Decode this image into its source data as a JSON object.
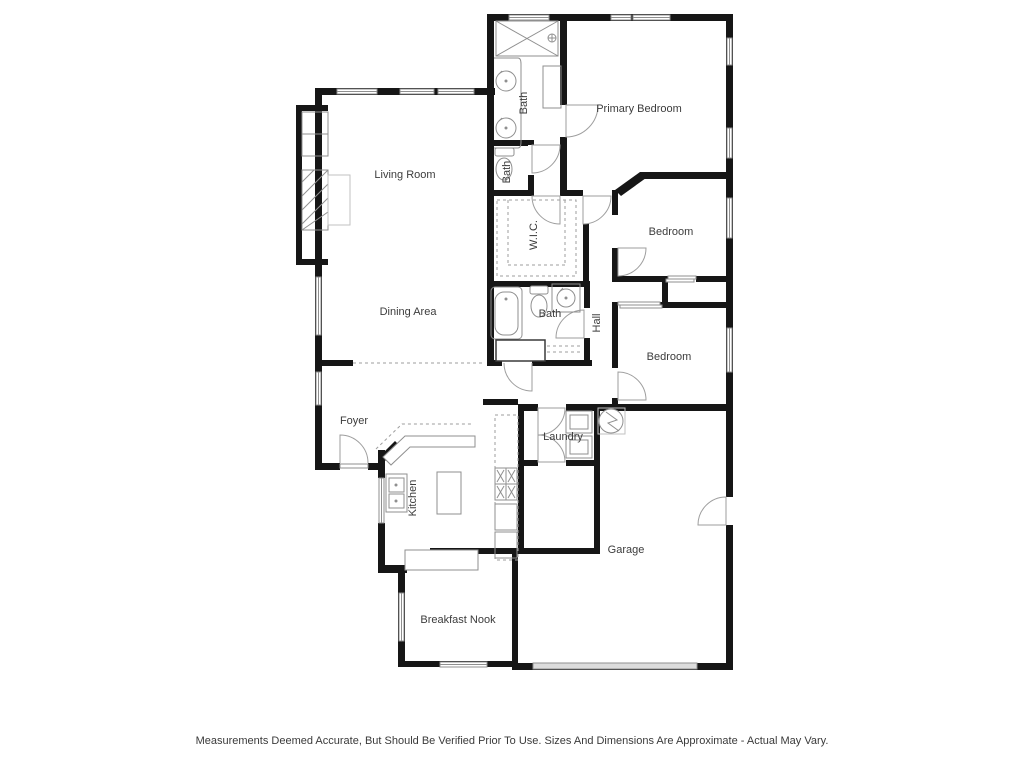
{
  "plan": {
    "rooms": [
      {
        "label": "Living Room"
      },
      {
        "label": "Dining Area"
      },
      {
        "label": "Primary Bedroom"
      },
      {
        "label": "Bath"
      },
      {
        "label": "Bath"
      },
      {
        "label": "W.I.C."
      },
      {
        "label": "Bath"
      },
      {
        "label": "Hall"
      },
      {
        "label": "Bedroom"
      },
      {
        "label": "Bedroom"
      },
      {
        "label": "Foyer"
      },
      {
        "label": "Kitchen"
      },
      {
        "label": "Laundry"
      },
      {
        "label": "Garage"
      },
      {
        "label": "Breakfast Nook"
      }
    ],
    "fixtures": [
      "shower",
      "double-vanity-sinks",
      "bench-cabinet",
      "toilet",
      "walk-in-closet-shelving",
      "bathtub",
      "toilet",
      "vanity-sink",
      "linen-closet",
      "fireplace",
      "built-in-shelves",
      "kitchen-island",
      "kitchen-sink",
      "stove",
      "kitchen-counter",
      "washer",
      "dryer",
      "water-heater",
      "garage-door"
    ],
    "colors": {
      "wall": "#161616",
      "fixture_line": "#8f8f8f",
      "door_arc": "#9e9e9e",
      "label_text": "#3c3c3c",
      "background": "#ffffff"
    },
    "disclaimer": "Measurements Deemed Accurate, But Should Be Verified Prior To Use. Sizes And Dimensions Are Approximate - Actual May Vary."
  }
}
